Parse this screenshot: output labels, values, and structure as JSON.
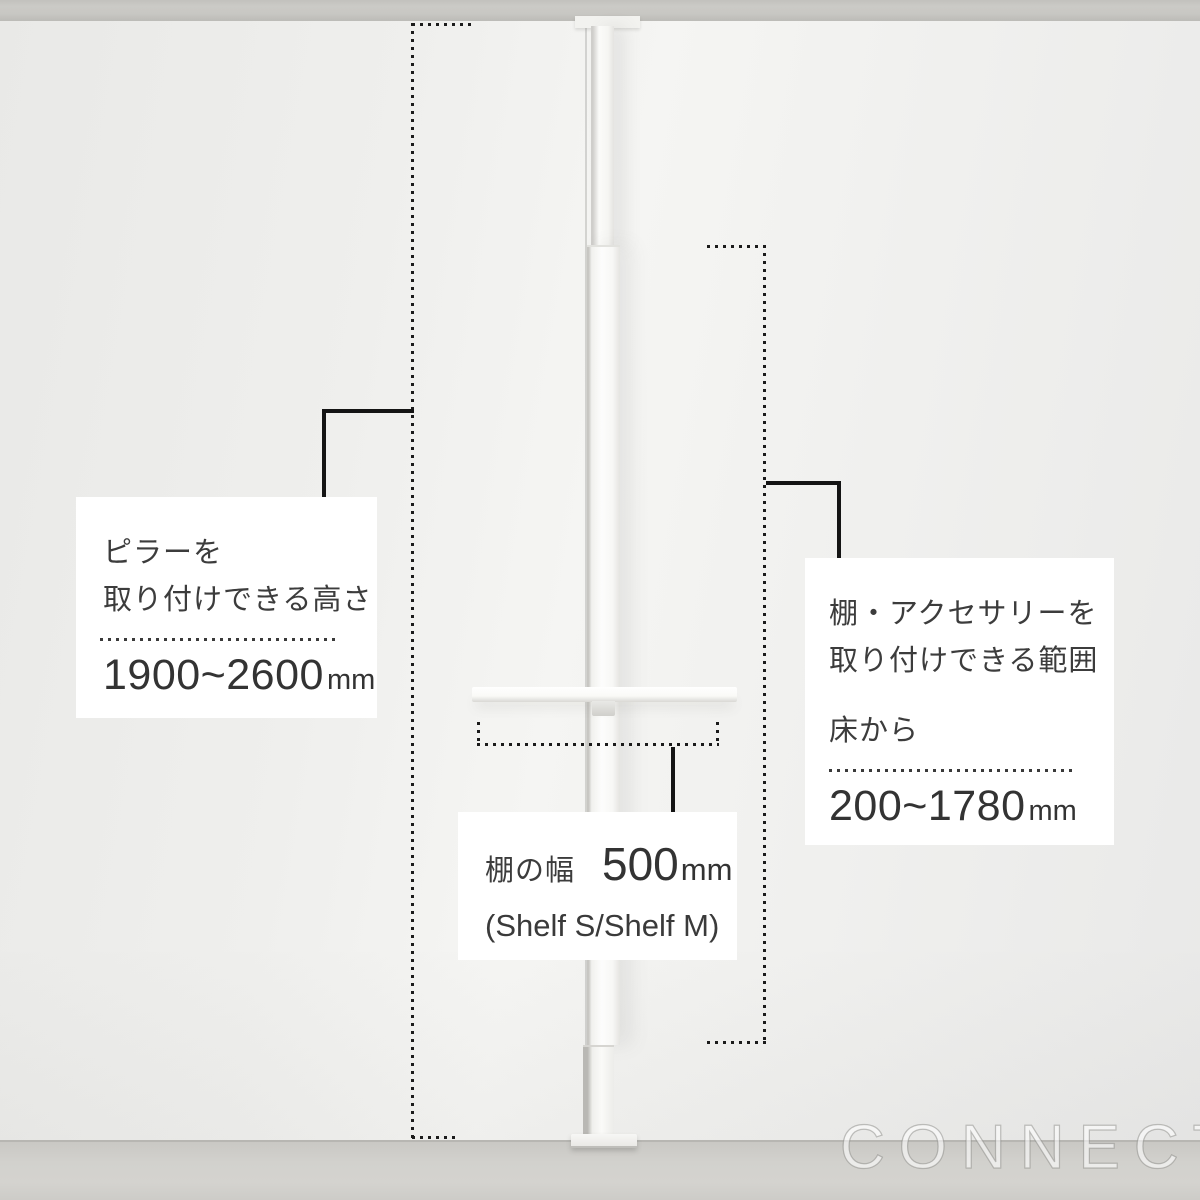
{
  "scene": {
    "watermark": "CONNECT"
  },
  "annotations": {
    "pillar_height": {
      "title_line1": "ピラーを",
      "title_line2": "取り付けできる高さ",
      "value": "1900~2600",
      "unit": "mm"
    },
    "mount_range": {
      "title_line1": "棚・アクセサリーを",
      "title_line2": "取り付けできる範囲",
      "subtitle": "床から",
      "value": "200~1780",
      "unit": "mm"
    },
    "shelf_width": {
      "title": "棚の幅",
      "value": "500",
      "unit": "mm",
      "note": "(Shelf S/Shelf M)"
    }
  },
  "colors": {
    "wall": "#f0f0ee",
    "ceiling": "#c8c7c3",
    "floor": "#d2d1cd",
    "pole": "#fbfbf9",
    "annotation_box_bg": "#ffffff",
    "annotation_text": "#3a3a3a",
    "measure_dots": "#1b1b1b",
    "connector_line": "#141414",
    "watermark": "rgba(255,255,255,0.58)"
  }
}
